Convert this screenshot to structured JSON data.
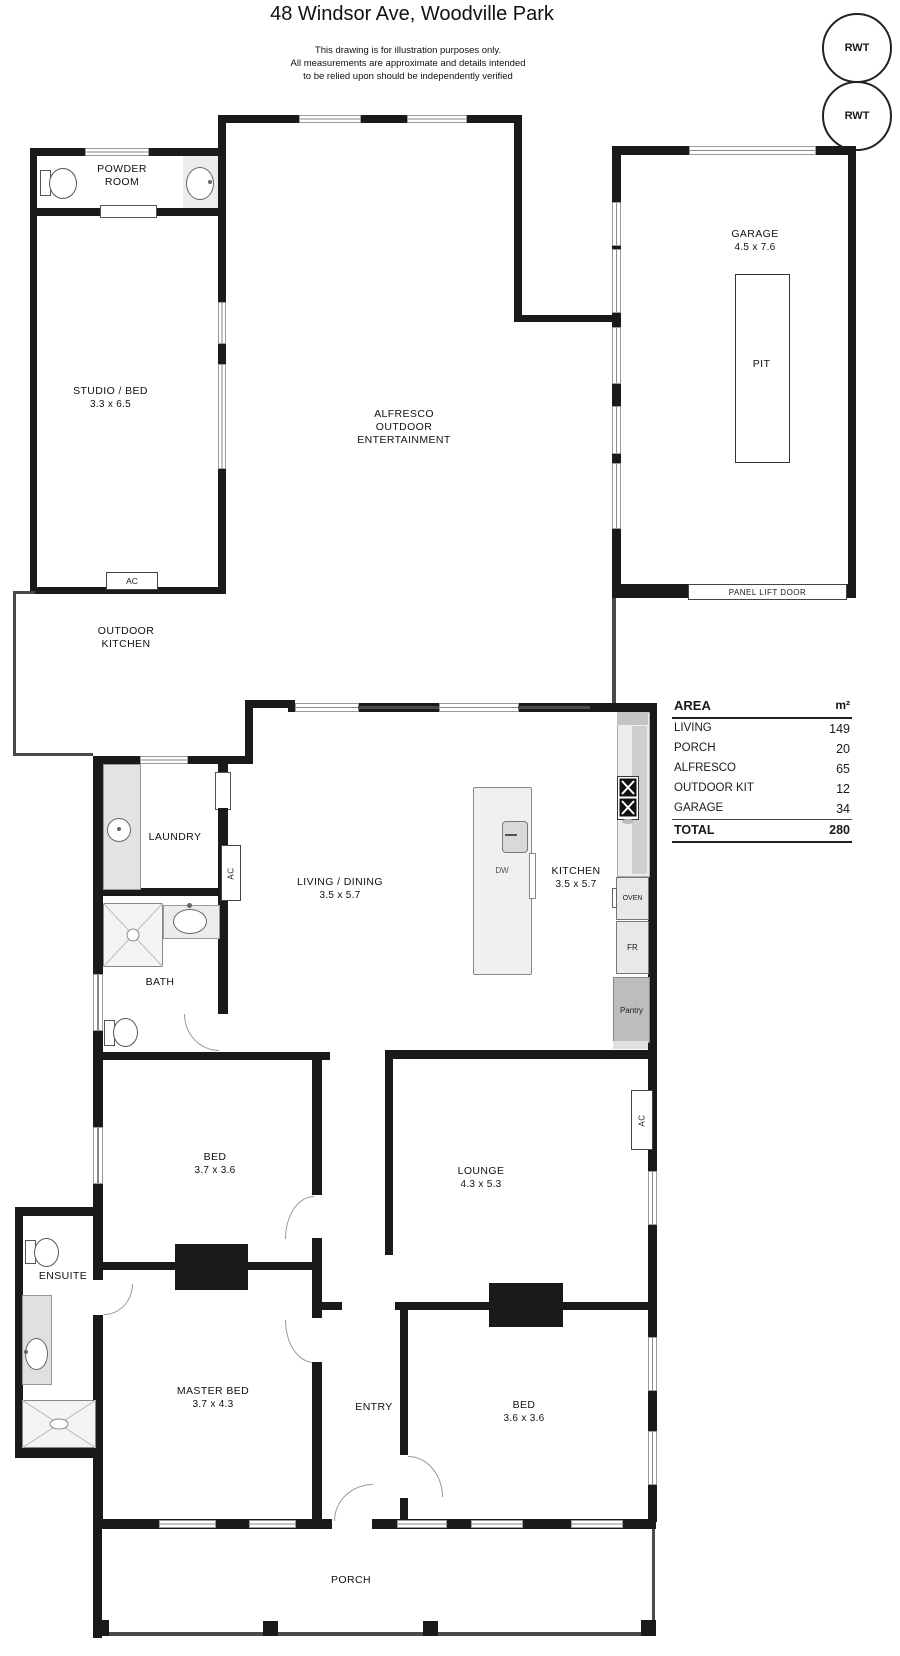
{
  "header": {
    "title": "48 Windsor Ave, Woodville Park",
    "disclaimer_line1": "This drawing is for illustration purposes only.",
    "disclaimer_line2": "All measurements are approximate and details intended",
    "disclaimer_line3": "to be relied upon should be independently verified"
  },
  "tanks": {
    "rwt_top": "RWT",
    "rwt_bottom": "RWT"
  },
  "rooms": {
    "powder_room": {
      "name_line1": "POWDER",
      "name_line2": "ROOM"
    },
    "studio": {
      "name": "STUDIO / BED",
      "dims": "3.3 x 6.5"
    },
    "alfresco": {
      "name_line1": "ALFRESCO",
      "name_line2": "OUTDOOR",
      "name_line3": "ENTERTAINMENT"
    },
    "garage": {
      "name": "GARAGE",
      "dims": "4.5 x 7.6",
      "pit_label": "PIT",
      "door_label": "PANEL LIFT DOOR"
    },
    "outdoor_kitchen": {
      "name_line1": "OUTDOOR",
      "name_line2": "KITCHEN"
    },
    "laundry": {
      "name": "LAUNDRY"
    },
    "living_dining": {
      "name": "LIVING / DINING",
      "dims": "3.5 x 5.7"
    },
    "kitchen": {
      "name": "KITCHEN",
      "dims": "3.5 x 5.7"
    },
    "bath": {
      "name": "BATH"
    },
    "bed1": {
      "name": "BED",
      "dims": "3.7 x 3.6"
    },
    "lounge": {
      "name": "LOUNGE",
      "dims": "4.3 x 5.3"
    },
    "ensuite": {
      "name": "ENSUITE"
    },
    "master_bed": {
      "name": "MASTER BED",
      "dims": "3.7 x 4.3"
    },
    "entry": {
      "name": "ENTRY"
    },
    "bed2": {
      "name": "BED",
      "dims": "3.6 x 3.6"
    },
    "porch": {
      "name": "PORCH"
    }
  },
  "appliances": {
    "ac_studio": "AC",
    "ac_laundry": "AC",
    "ac_lounge": "AC",
    "dw": "DW",
    "oven": "OVEN",
    "fridge": "FR",
    "pantry": "Pantry"
  },
  "area_table": {
    "header_label": "AREA",
    "header_unit": "m²",
    "rows": [
      {
        "label": "LIVING",
        "value": "149"
      },
      {
        "label": "PORCH",
        "value": "20"
      },
      {
        "label": "ALFRESCO",
        "value": "65"
      },
      {
        "label": "OUTDOOR KIT",
        "value": "12"
      },
      {
        "label": "GARAGE",
        "value": "34"
      }
    ],
    "total_label": "TOTAL",
    "total_value": "280"
  },
  "colors": {
    "wall": "#1a1a1a",
    "fixture_gray": "#ececec",
    "bench_gray": "#c9c9c9",
    "robe": "#111111"
  }
}
